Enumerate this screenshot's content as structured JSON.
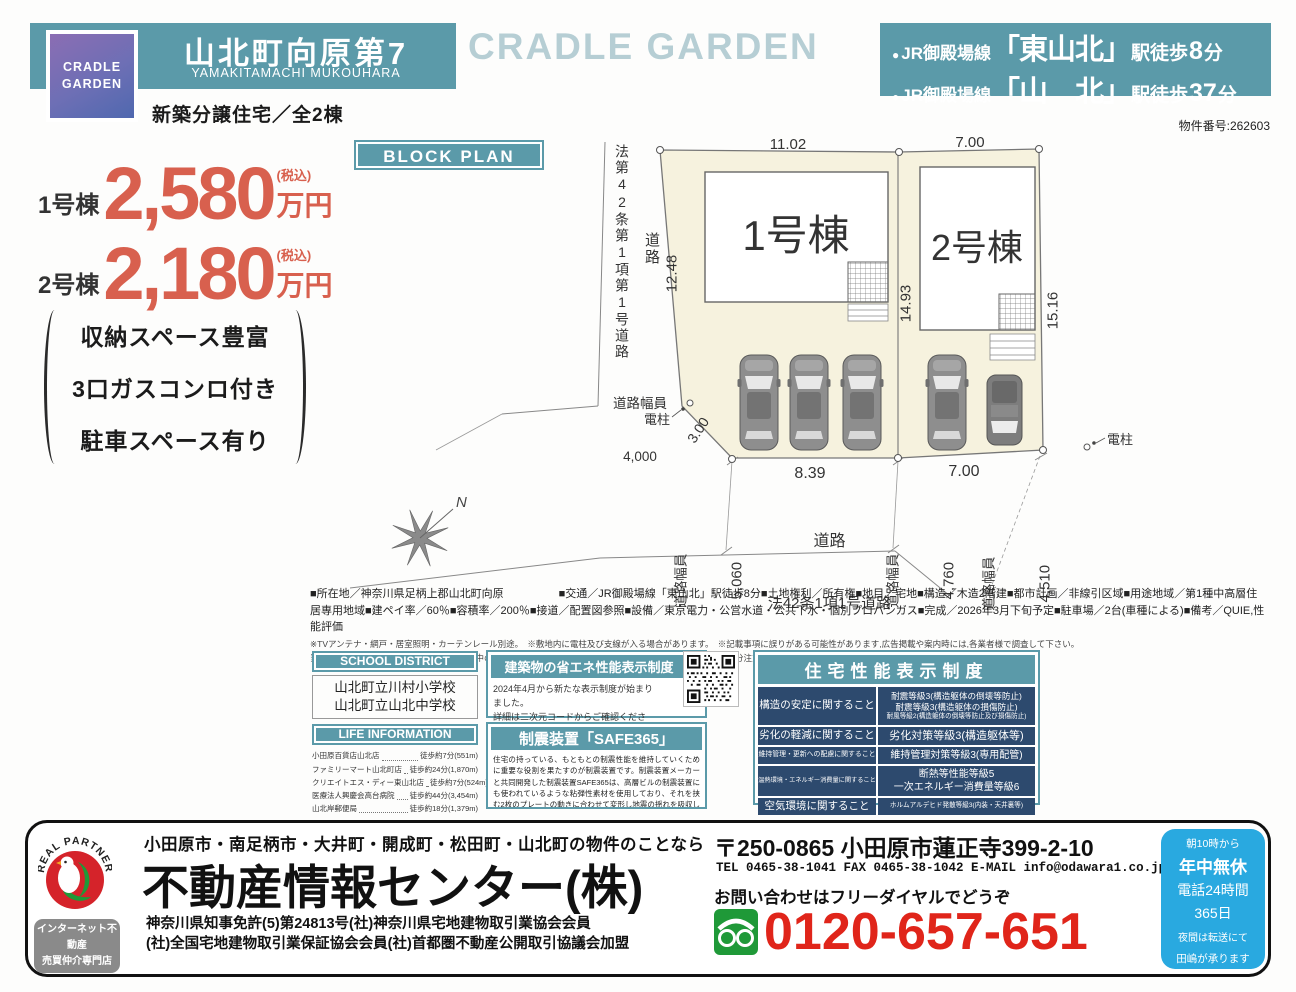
{
  "header": {
    "logo_line1": "CRADLE",
    "logo_line2": "GARDEN",
    "title": "山北町向原第7",
    "romaji": "YAMAKITAMACHI MUKOUHARA",
    "subtitle": "新築分譲住宅／全2棟",
    "watermark": "CRADLE GARDEN",
    "access": [
      {
        "bullet": "●",
        "line": "JR御殿場線",
        "station": "「東山北」",
        "walk": "駅徒歩",
        "num": "8",
        "suffix": "分"
      },
      {
        "bullet": "●",
        "line": "JR御殿場線",
        "station": "「山　北」",
        "walk": "駅徒歩",
        "num": "37",
        "suffix": "分"
      }
    ],
    "property_number": "物件番号:262603"
  },
  "prices": [
    {
      "name": "1号棟",
      "amount": "2,580",
      "tax": "(税込)",
      "unit": "万円"
    },
    {
      "name": "2号棟",
      "amount": "2,180",
      "tax": "(税込)",
      "unit": "万円"
    }
  ],
  "features": [
    "収納スペース豊富",
    "3口ガスコンロ付き",
    "駐車スペース有り"
  ],
  "block_plan": {
    "label": "BLOCK PLAN",
    "road_law_vertical": "法第42条第1項第1号道路",
    "road_vertical": "道路",
    "dim_road_left": "12.48",
    "dim_top_1": "11.02",
    "dim_top_2": "7.00",
    "dim_mid": "14.93",
    "dim_right": "15.16",
    "building_1": "1号棟",
    "building_2": "2号棟",
    "road_width_label": "道路幅員",
    "road_width_4000": "4,000",
    "pole_left": "電柱",
    "pole_right": "電柱",
    "dim_diag": "3.00",
    "dim_bottom_1": "8.39",
    "dim_bottom_2": "7.00",
    "rw_5060_label": "道路幅員",
    "rw_5060": "5,060",
    "road_center_1": "道路",
    "road_center_2": "法42条1項1号道路",
    "rw_4760_label": "道路幅員",
    "rw_4760": "4,760",
    "rw_4510_label": "道路幅員",
    "rw_4510": "4,510",
    "compass": "N"
  },
  "property_details": {
    "specs": "■所在地／神奈川県足柄上郡山北町向原　　　　　■交通／JR御殿場線「東山北」駅徒歩8分■土地権利／所有権■地目／宅地■構造／木造2階建■都市計画／非線引区域■用途地域／第1種中高層住居専用地域■建ペイ率／60％■容積率／200％■接道／配置図参照■設備／東京電力・公営水道・公共下水・個別プロパンガス■完成／2026年3月下旬予定■駐車場／2台(車種による)■備考／QUIE,性能評価",
    "note_1": "※TVアンテナ・網戸・居室照明・カーテンレール別途。　※敷地内に電柱及び支線が入る場合があります。　※記載事項に誤りがある可能性があります,広告掲載や案内時には,各業者様で調査して下さい。",
    "note_2": "当社では一切の責任を負いません。　◎建築中の現場につき,事故等ないようヘルメット及びスリッパを用意し,十分注意の上ご案内をお願い致します。"
  },
  "school": {
    "header": "SCHOOL DISTRICT",
    "items": [
      "山北町立川村小学校",
      "山北町立山北中学校"
    ]
  },
  "life": {
    "header": "LIFE INFORMATION",
    "items": [
      {
        "name": "小田原百貨店山北店",
        "value": "徒歩約7分(551m)"
      },
      {
        "name": "ファミリーマート山北町店",
        "value": "徒歩約24分(1,870m)"
      },
      {
        "name": "クリエイトエス・ディー東山北店",
        "value": "徒歩約7分(524m)"
      },
      {
        "name": "医療法人興慶会高台病院",
        "value": "徒歩約44分(3,454m)"
      },
      {
        "name": "山北岸郵便局",
        "value": "徒歩約18分(1,379m)"
      }
    ]
  },
  "energy": {
    "header": "建築物の省エネ性能表示制度",
    "body_1": "2024年4月から新たな表示制度が始まりました。",
    "body_2": "詳細は二次元コードからご確認ください。"
  },
  "seismic": {
    "header": "制震装置「SAFE365」",
    "body": "住宅の持っている、もともとの制震性能を維持していくために重要な役割を果たすのが制震装置です。制震装置メーカーと共同開発した制震装置SAFE365は、高層ビルの制震装置にも使われているような粘弾性素材を使用しており、それを挟む2枚のプレートの動きに合わせて変形し地震の揺れを吸収します。"
  },
  "performance": {
    "header": "住宅性能表示制度",
    "rows": [
      {
        "category": "構造の安定に関すること",
        "values": [
          "耐震等級3(構造躯体の倒壊等防止)",
          "耐震等級3(構造躯体の損傷防止)",
          "耐風等級2(構造躯体の倒壊等防止及び損傷防止)"
        ]
      },
      {
        "category": "劣化の軽減に関すること",
        "values": [
          "劣化対策等級3(構造躯体等)"
        ]
      },
      {
        "category": "維持管理・更新への配慮に関すること",
        "values": [
          "維持管理対策等級3(専用配管)"
        ]
      },
      {
        "category": "温熱環境・エネルギー消費量に関すること",
        "values": [
          "断熱等性能等級5",
          "一次エネルギー消費量等級6"
        ]
      },
      {
        "category": "空気環境に関すること",
        "values": [
          "ホルムアルデヒド発散等級3(内装・天井裏等)"
        ]
      }
    ]
  },
  "footer": {
    "real_partner": "REAL PARTNER",
    "badge_1": "インターネット不動産",
    "badge_2": "売買仲介専門店",
    "catchline": "小田原市・南足柄市・大井町・開成町・松田町・山北町の物件のことなら",
    "company": "不動産情報センター(株)",
    "license_1": "神奈川県知事免許(5)第24813号(社)神奈川県宅地建物取引業協会会員",
    "license_2": "(社)全国宅地建物取引業保証協会会員(社)首都圏不動産公開取引協議会加盟",
    "address": "〒250-0865 小田原市蓮正寺399-2-10",
    "contact": "TEL 0465-38-1041 FAX 0465-38-1042 E-MAIL info@odawara1.co.jp",
    "freedial_note": "お問い合わせはフリーダイヤルでどうぞ",
    "freedial_number": "0120-657-651",
    "hours": [
      "朝10時から",
      "年中無休",
      "電話24時間",
      "365日",
      "夜間は転送にて",
      "田嶋が承ります"
    ]
  },
  "colors": {
    "teal": "#5b9aa9",
    "price_red": "#d8604e",
    "table_navy": "#2d4a6e",
    "hours_blue": "#29a9e0",
    "freedial_green": "#1f9938",
    "logo_red": "#d5232a",
    "plan_cream": "#f6f2de"
  }
}
